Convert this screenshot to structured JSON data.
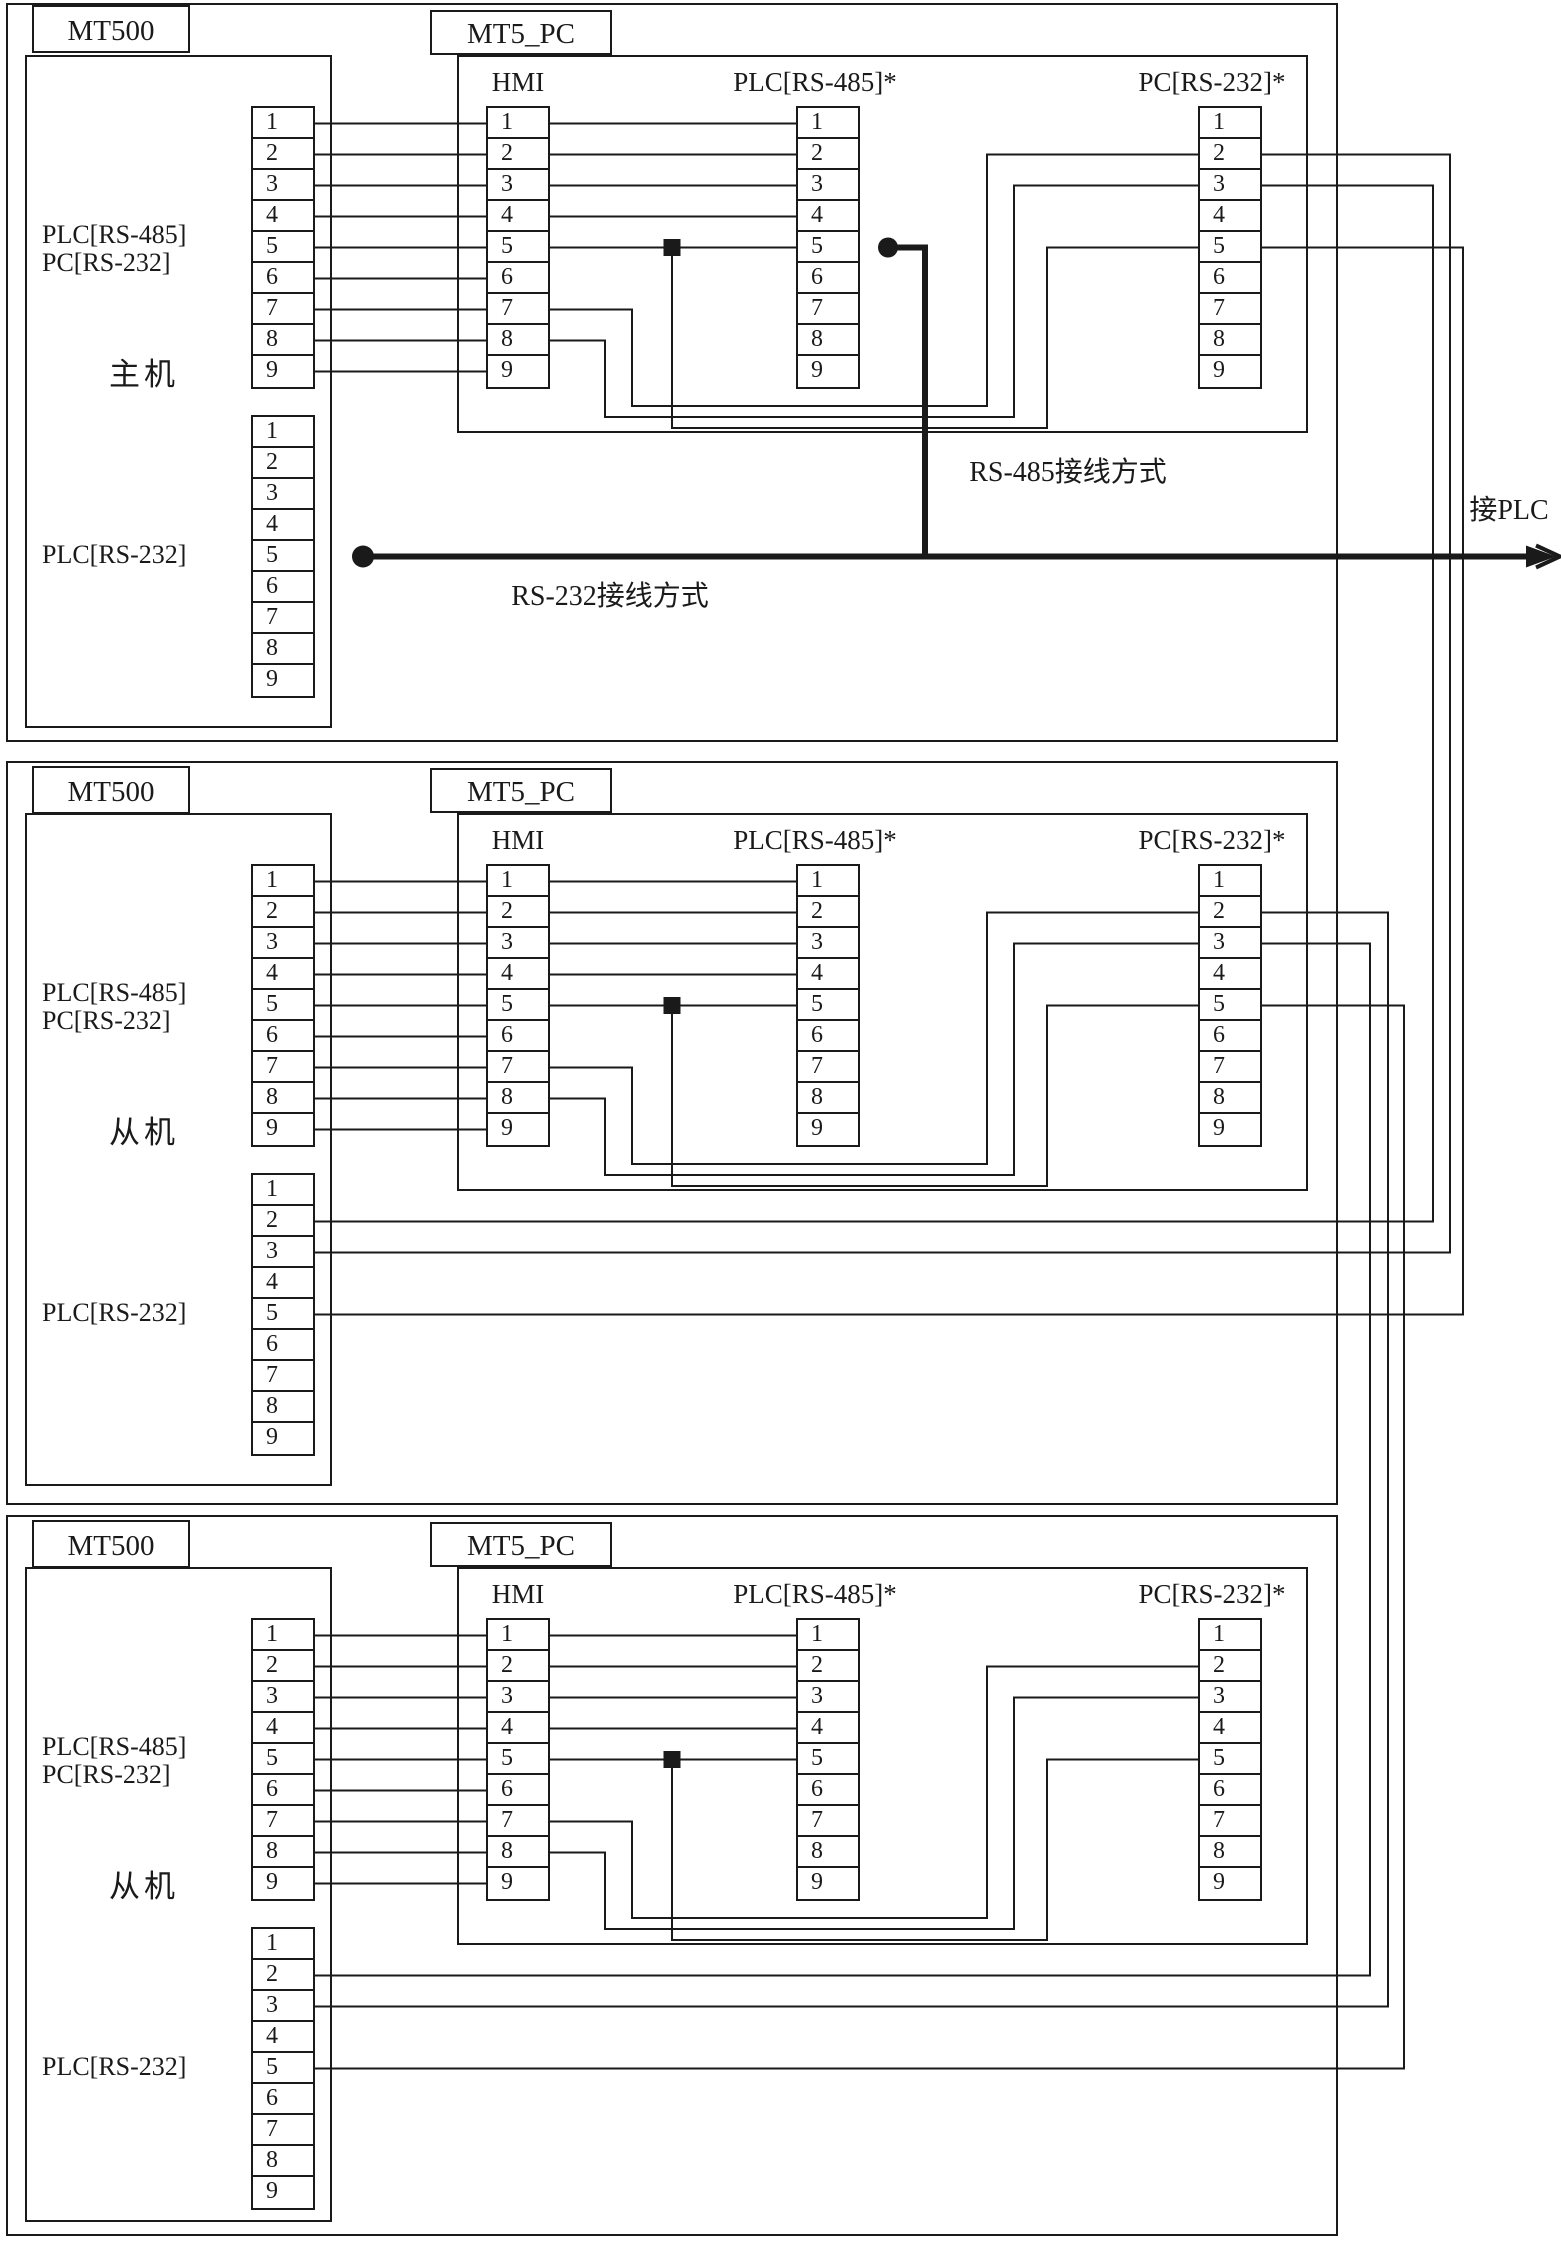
{
  "pins": [
    "1",
    "2",
    "3",
    "4",
    "5",
    "6",
    "7",
    "8",
    "9"
  ],
  "blocks": [
    {
      "device_title": "MT500",
      "hub_title": "MT5_PC",
      "role": "主机",
      "port_type_label": "PLC[RS-485]\nPC[RS-232]",
      "lower_port_label": "PLC[RS-232]",
      "connector_labels": {
        "hmi": "HMI",
        "plc485": "PLC[RS-485]*",
        "pc232": "PC[RS-232]*"
      }
    },
    {
      "device_title": "MT500",
      "hub_title": "MT5_PC",
      "role": "从机",
      "port_type_label": "PLC[RS-485]\nPC[RS-232]",
      "lower_port_label": "PLC[RS-232]",
      "connector_labels": {
        "hmi": "HMI",
        "plc485": "PLC[RS-485]*",
        "pc232": "PC[RS-232]*"
      }
    },
    {
      "device_title": "MT500",
      "hub_title": "MT5_PC",
      "role": "从机",
      "port_type_label": "PLC[RS-485]\nPC[RS-232]",
      "lower_port_label": "PLC[RS-232]",
      "connector_labels": {
        "hmi": "HMI",
        "plc485": "PLC[RS-485]*",
        "pc232": "PC[RS-232]*"
      }
    }
  ],
  "annotations": {
    "rs485_mode": "RS-485接线方式",
    "rs232_mode": "RS-232接线方式",
    "to_plc": "接PLC"
  },
  "colors": {
    "ink": "#1a1a1a",
    "background": "#ffffff"
  },
  "wiring": {
    "mt500_to_hmi_pins": [
      1,
      2,
      3,
      4,
      5,
      6,
      7,
      8,
      9
    ],
    "hmi_to_plc485_pins": [
      1,
      2,
      3,
      4,
      5
    ],
    "internal_wraps": [
      {
        "from": "HMI-7",
        "to": "PC232-2"
      },
      {
        "from": "HMI-8",
        "to": "PC232-3"
      },
      {
        "from": "PLC485-5-gnd-junction",
        "to": "PC232-5"
      }
    ],
    "block_chain": [
      {
        "from_block": 0,
        "from": "PC232-3",
        "to_block": 1,
        "to": "PLC232-2"
      },
      {
        "from_block": 0,
        "from": "PC232-2",
        "to_block": 1,
        "to": "PLC232-3"
      },
      {
        "from_block": 0,
        "from": "PC232-5",
        "to_block": 1,
        "to": "PLC232-5"
      },
      {
        "from_block": 1,
        "from": "PC232-3",
        "to_block": 2,
        "to": "PLC232-2"
      },
      {
        "from_block": 1,
        "from": "PC232-2",
        "to_block": 2,
        "to": "PLC232-3"
      },
      {
        "from_block": 1,
        "from": "PC232-5",
        "to_block": 2,
        "to": "PLC232-5"
      }
    ],
    "master_buses": [
      {
        "type": "RS-485",
        "from": "PLC485-5",
        "label": "RS-485接线方式"
      },
      {
        "type": "RS-232",
        "from": "PLC232-5",
        "label": "RS-232接线方式",
        "to": "接PLC"
      }
    ]
  }
}
